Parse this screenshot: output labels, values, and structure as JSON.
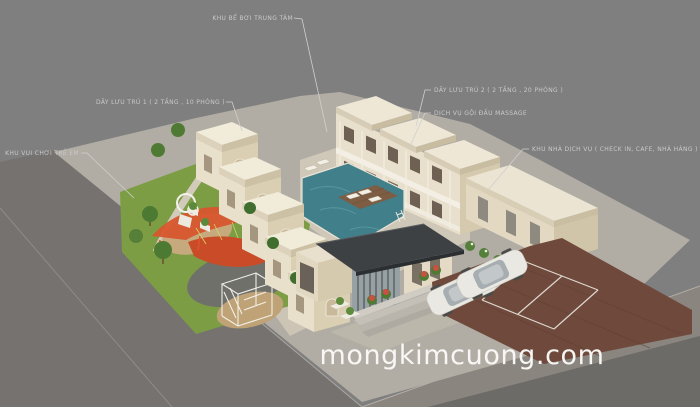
{
  "annotations": {
    "pool": {
      "label": "KHU BỂ BƠI TRUNG TÂM"
    },
    "row1": {
      "label": "DÃY LƯU TRÚ 1 ( 2 TẦNG , 10 PHÒNG )"
    },
    "row2": {
      "label": "DÃY LƯU TRÚ 2 ( 2 TẦNG , 20 PHÒNG )"
    },
    "massage": {
      "label": "DỊCH VỤ GỘI ĐẦU MASSAGE"
    },
    "service": {
      "label": "KHU NHÀ DỊCH VỤ ( CHECK IN, CAFE, NHÀ HÀNG )"
    },
    "playground": {
      "label": "KHU VUI CHƠI TRẺ EM"
    }
  },
  "watermark": {
    "text": "mongkimcuong.com"
  },
  "colors": {
    "background": "#7f7f7f",
    "road": "#757270",
    "pool_water": "#417f8a",
    "grass": "#7d9d45",
    "parking_brick": "#6f4a3c",
    "building_cream": "#e9e0cc",
    "canopy_dark": "#3d4144",
    "play_structure_red": "#d8562e",
    "label_text": "#c9c9c9",
    "watermark_text": "#fbfbf9"
  }
}
